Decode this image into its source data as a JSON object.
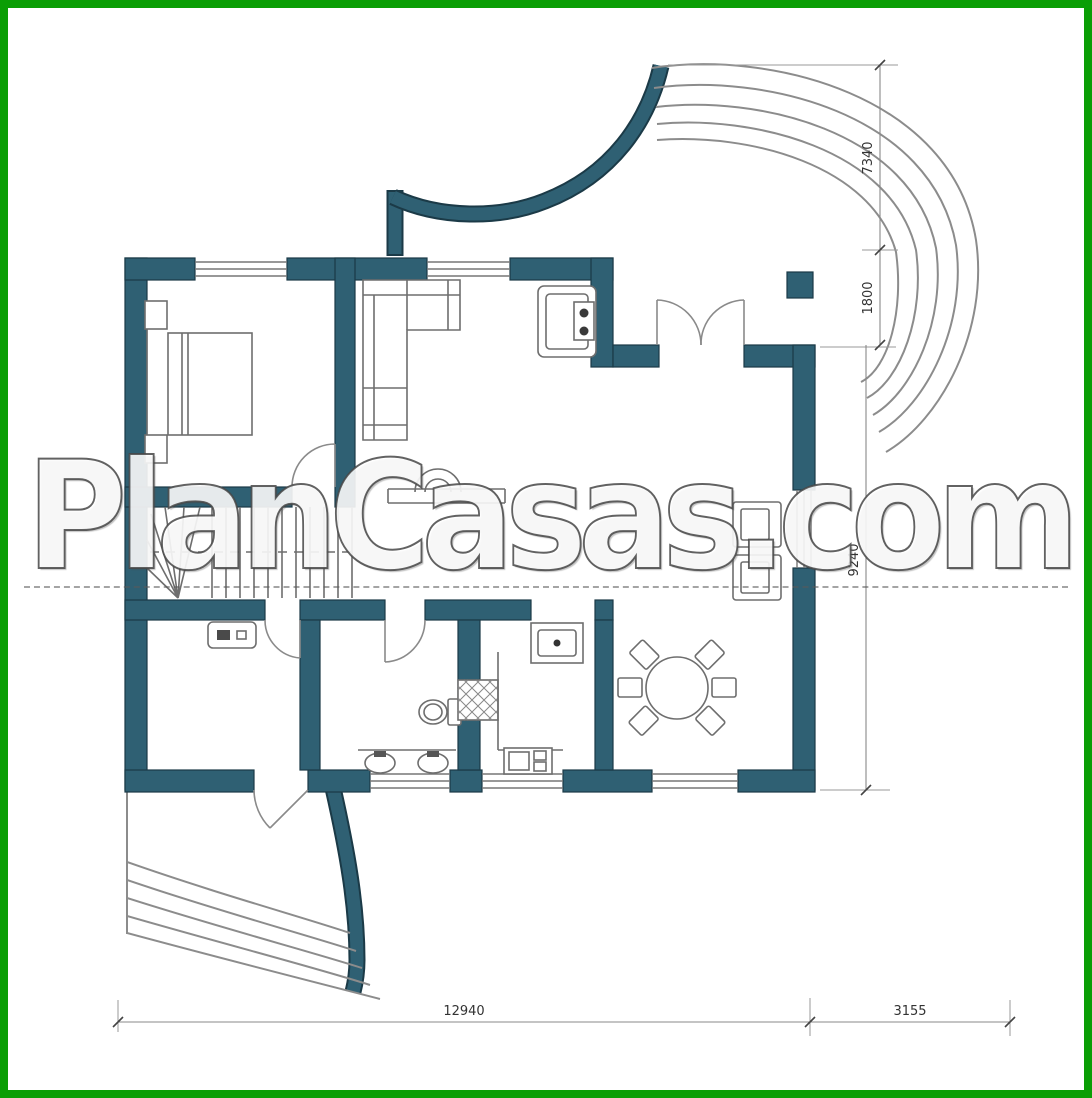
{
  "watermark": {
    "text": "PlanCasas.com"
  },
  "dimensions": {
    "bottom_main": "12940",
    "bottom_right": "3155",
    "right_top": "7340",
    "right_mid": "1800",
    "right_lower": "9240"
  },
  "colors": {
    "frame_green": "#0a9e05",
    "wall_teal": "#2f6073",
    "wall_outline": "#1b3a47",
    "furniture_line": "#6e6e6e",
    "terrace_steps_line": "#8c8c8c",
    "dimension_line": "#888888",
    "dimension_text": "#333333",
    "background": "#ffffff",
    "watermark_fill": "#ffffff",
    "watermark_outline": "#464646"
  },
  "plan": {
    "type": "single-floor house plan",
    "features": [
      "bedroom-with-double-bed",
      "staircase-with-winders",
      "study-room",
      "bathroom-with-toilet-and-double-sink",
      "kitchen-with-counter-sink-stove",
      "dining-area-round-table-six-chairs",
      "living-room-corner-sofa",
      "fireplace-unit",
      "two-armchairs-by-window",
      "entrance-double-door",
      "freestanding-column",
      "curved-terrace-steps-top-right",
      "curved-terrace-steps-bottom-left"
    ]
  }
}
